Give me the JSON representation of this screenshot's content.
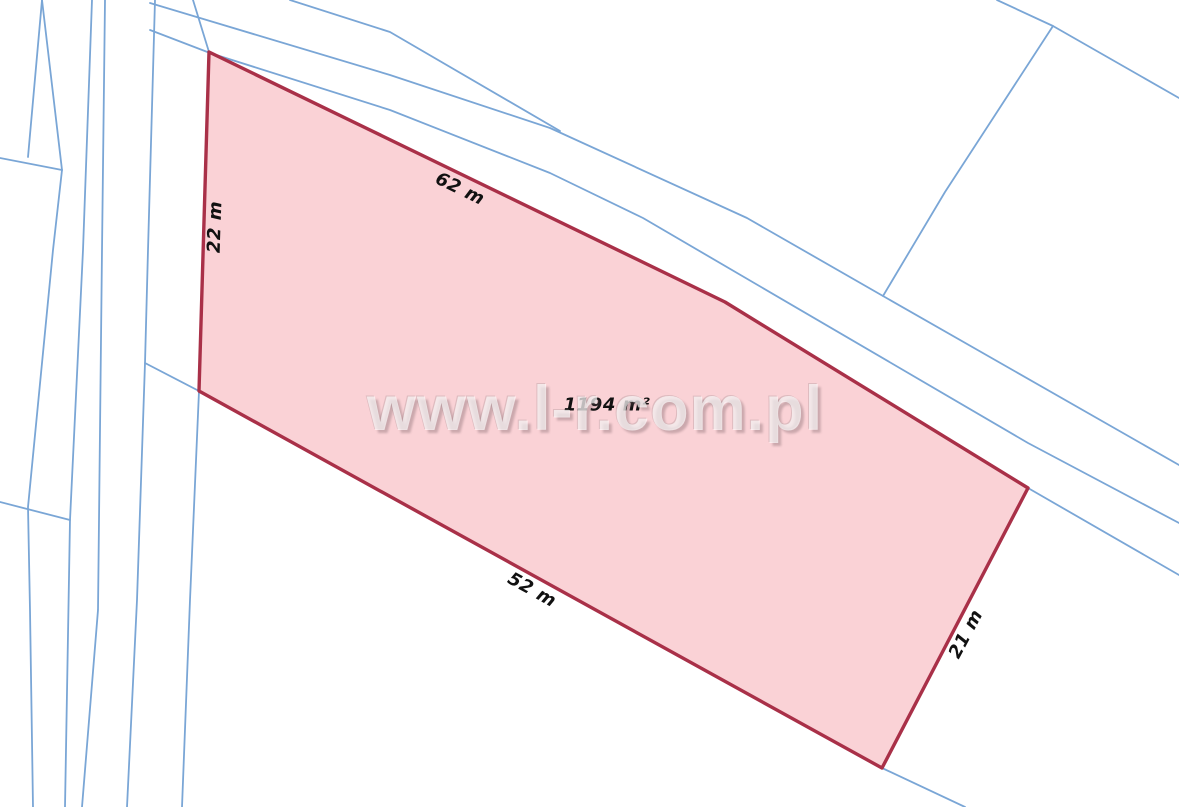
{
  "map": {
    "type": "cadastral-plot-map",
    "watermark": {
      "text": "www.l-r.com.pl"
    },
    "parcel": {
      "area_label": "1194 m²",
      "dimensions": {
        "top": "62 m",
        "left": "22 m",
        "bottom": "52 m",
        "right": "21 m"
      }
    },
    "colors": {
      "background": "#ffffff",
      "parcel_fill": "#fad2d6",
      "parcel_stroke": "#a93048",
      "boundary_blue": "#7aa6d6",
      "label_text": "#111111"
    }
  }
}
